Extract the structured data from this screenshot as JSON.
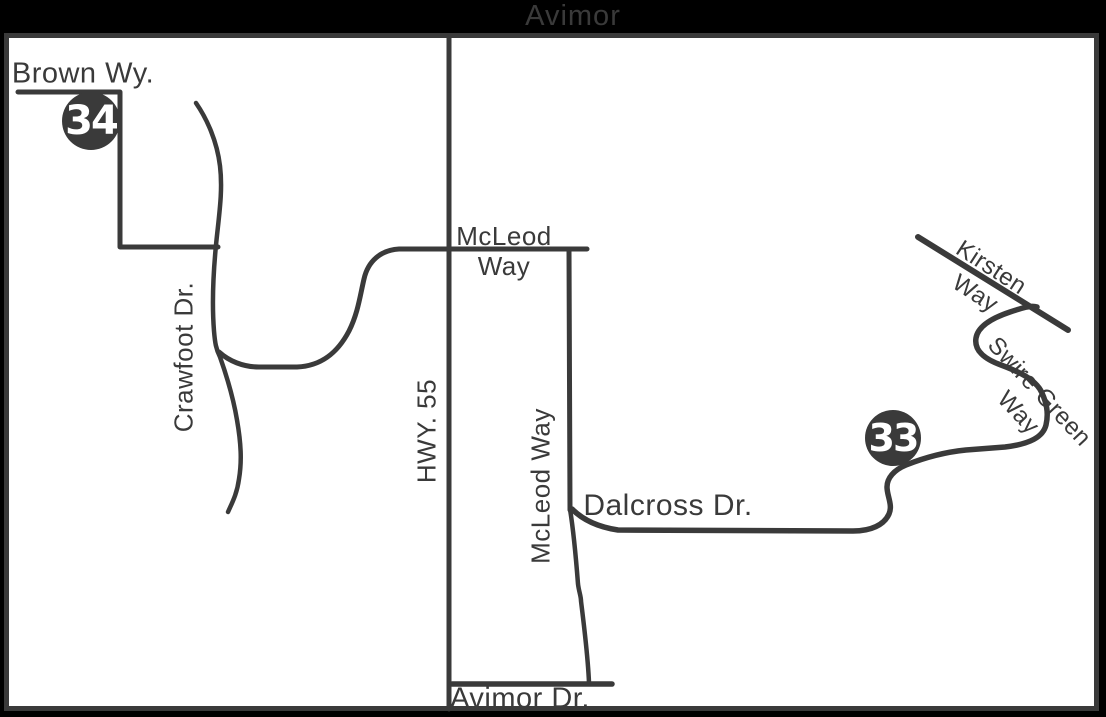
{
  "title": "Avimor",
  "colors": {
    "ink": "#3a3a3a",
    "background": "#000000",
    "map_fill": "#ffffff",
    "marker_fill": "#3a3a3a",
    "marker_text": "#ffffff"
  },
  "labels": {
    "brown_wy": "Brown Wy.",
    "crawfoot": "Crawfoot Dr.",
    "hwy_55": "HWY. 55",
    "mcleod_top_line1": "McLeod",
    "mcleod_top_line2": "Way",
    "mcleod_vertical": "McLeod Way",
    "dalcross": "Dalcross Dr.",
    "kirsten_line1": "Kirsten",
    "kirsten_line2": "Way",
    "swire_line1": "Swire Green",
    "swire_line2": "Way",
    "avimor_dr": "Avimor Dr."
  },
  "markers": {
    "lot_34": "34",
    "lot_33": "33"
  }
}
